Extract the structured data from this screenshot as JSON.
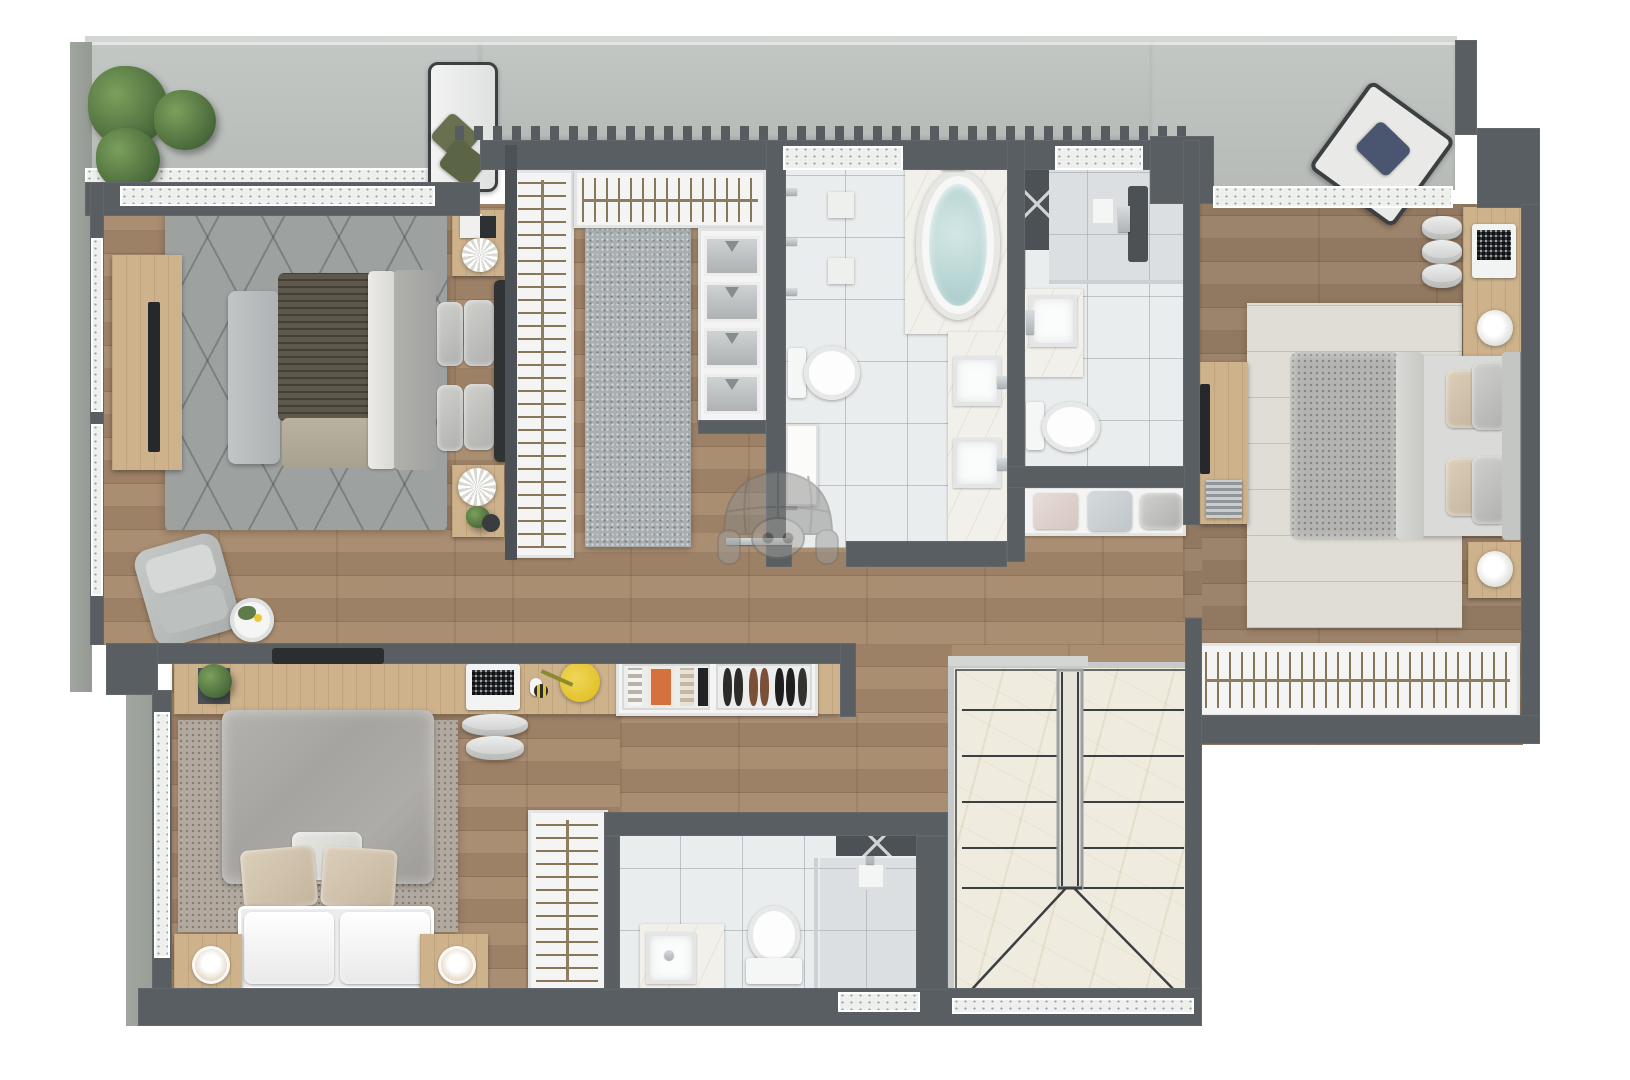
{
  "meta": {
    "title": "apartment-upper-floor-plan",
    "view": "top-down 3d architectural render",
    "visible_text": "none"
  },
  "palette": {
    "background": "#ffffff",
    "wall": "#585e61",
    "wall_dark": "#4b5154",
    "wood_floor": "#a5886b",
    "light_wood": "#cdb28c",
    "terrace_concrete": "#bcc0bd",
    "exterior_concrete": "#9aa09a",
    "bathroom_tile": "#eaedee",
    "stair_marble": "#efecdf",
    "master_rug": "#9da2a1",
    "speckle_rug": "#b2aaa0",
    "cream_rug": "#e0ddd7",
    "closet_runner": "#a9aeb0",
    "knit_blanket": "#5e584c",
    "plant_green": "#5d7c4a",
    "tub_water": "#c0dcdb",
    "desk_lamp_yellow": "#e9ca36",
    "navy_pillow": "#4a5570",
    "watermark_gray": "#8b8b89"
  },
  "watermark": {
    "name": "pig-dome-logo",
    "description": "translucent pig face under glass dome",
    "opacity": 0.5
  },
  "rooms": {
    "balcony_left": {
      "label": "Left balcony with planters and bench"
    },
    "balcony_right": {
      "label": "Right balcony with lounge chair"
    },
    "master_bedroom": {
      "label": "Master bedroom"
    },
    "walk_in_closet": {
      "label": "Walk-in closet"
    },
    "master_bathroom": {
      "label": "Master bathroom with oval tub"
    },
    "second_bathroom": {
      "label": "Second bathroom with shower"
    },
    "bedroom_right": {
      "label": "Right bedroom with desk"
    },
    "bedroom_lower": {
      "label": "Lower bedroom"
    },
    "third_bathroom": {
      "label": "Lower bathroom with shower"
    },
    "staircase": {
      "label": "U-shaped marble staircase"
    },
    "hallway": {
      "label": "Hallway with wall desk and shoe cabinet"
    }
  },
  "furniture": {
    "master_bed": {
      "label": "King bed with knit throw and pillows"
    },
    "master_tv": {
      "label": "TV sideboard"
    },
    "foot_bench": {
      "label": "Bench at foot of bed"
    },
    "armchair": {
      "label": "Gray lounge armchair"
    },
    "side_table": {
      "label": "Round side table with plant"
    },
    "closet_racks": {
      "label": "Hanging rails with clothes"
    },
    "shirt_shelves": {
      "label": "Folded shirt shelves"
    },
    "closet_runner": {
      "label": "Gray closet runner rug"
    },
    "bathtub": {
      "label": "Oval bathtub on marble deck"
    },
    "double_vanity": {
      "label": "Double vessel-sink vanity"
    },
    "toilet": {
      "label": "Toilet"
    },
    "shower": {
      "label": "Walk-in shower"
    },
    "linen_niche": {
      "label": "Linen niche with cushions"
    },
    "right_bed": {
      "label": "Double bed with gray duvet"
    },
    "right_desk": {
      "label": "Desk with laptop and lamp"
    },
    "right_sideboard": {
      "label": "Low sideboard with TV"
    },
    "right_closet": {
      "label": "Wardrobe rail with hangers"
    },
    "lower_bed": {
      "label": "Double bed with soft gray duvet"
    },
    "study_desk": {
      "label": "Wall desk with laptop, lamp and plant"
    },
    "shoe_cabinet": {
      "label": "Shoe and accessories drawer"
    },
    "wardrobe": {
      "label": "Wardrobe cabinet with rail"
    },
    "stairs": {
      "label": "Marble stair flights with center rail"
    },
    "lounge_chair": {
      "label": "Outdoor lounge chair with navy pillow"
    },
    "terrace_bench": {
      "label": "Outdoor bench with olive pillows"
    },
    "plants": {
      "label": "Planter shrubs"
    },
    "pig_watermark": {
      "label": "Translucent pig dome watermark"
    }
  }
}
